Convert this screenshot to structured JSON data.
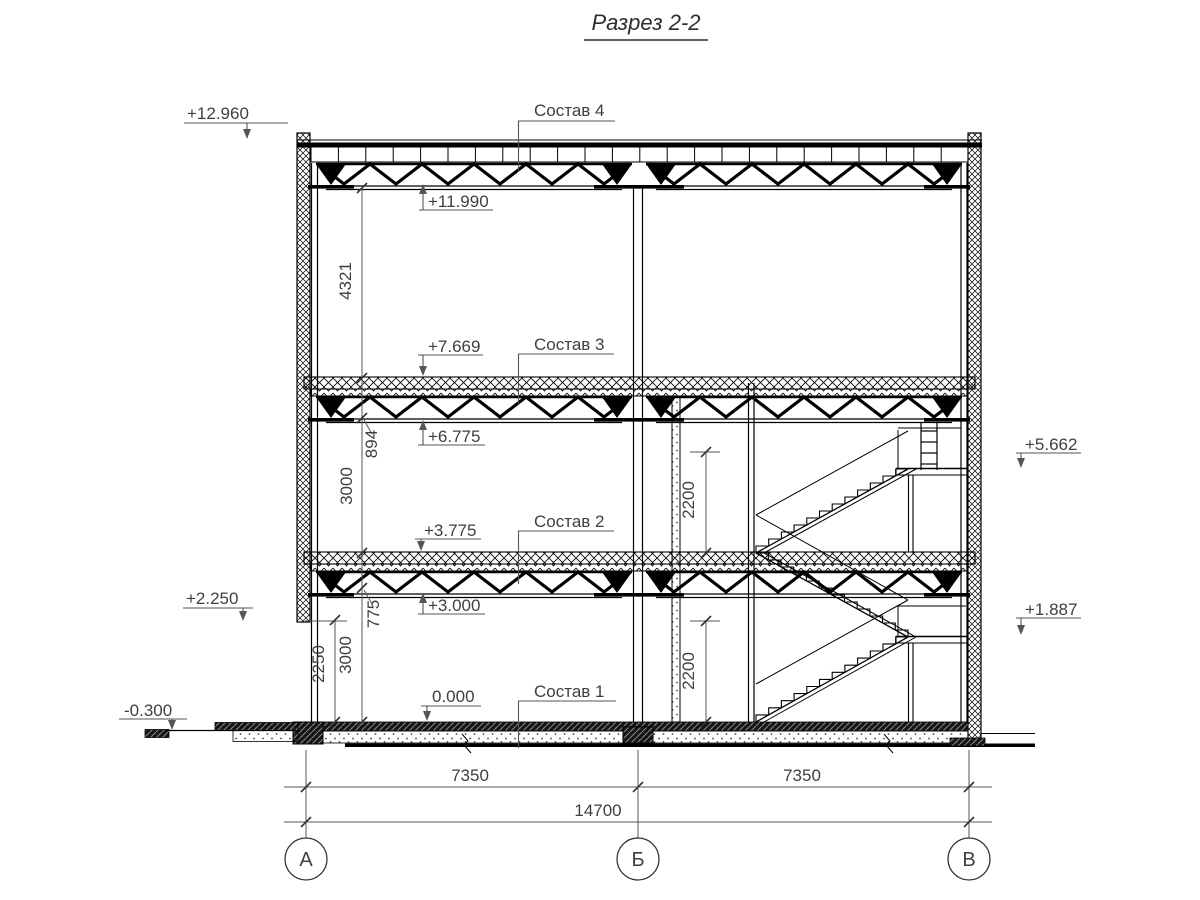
{
  "title": "Разрез 2-2",
  "composition_labels": {
    "c4": "Состав 4",
    "c3": "Состав 3",
    "c2": "Состав 2",
    "c1": "Состав 1"
  },
  "elevations": {
    "parapet_top": "+12.960",
    "roof_truss_bottom": "+11.990",
    "floor3_top": "+7.669",
    "floor3_truss_bottom": "+6.775",
    "landing_upper": "+5.662",
    "floor2_top": "+3.775",
    "floor2_truss_bottom": "+3.000",
    "wall_panel_bottom": "+2.250",
    "landing_lower": "+1.887",
    "ground_floor": "0.000",
    "outside_ground": "-0.300"
  },
  "vertical_dimensions": {
    "roof_story": "4321",
    "floor3_structure_depth": "894",
    "story_upper": "3000",
    "floor2_structure_depth": "775",
    "story_lower": "3000",
    "panel_opening": "2250",
    "stair_clearance_upper": "2200",
    "stair_clearance_lower": "2200"
  },
  "horizontal_dimensions": {
    "span_a_b": "7350",
    "span_b_v": "7350",
    "total": "14700"
  },
  "axes": {
    "left": "А",
    "middle": "Б",
    "right": "В"
  },
  "colors": {
    "line": "#000000",
    "annotation": "#3f3f3f",
    "dimension_line": "#555555",
    "background": "#ffffff"
  }
}
